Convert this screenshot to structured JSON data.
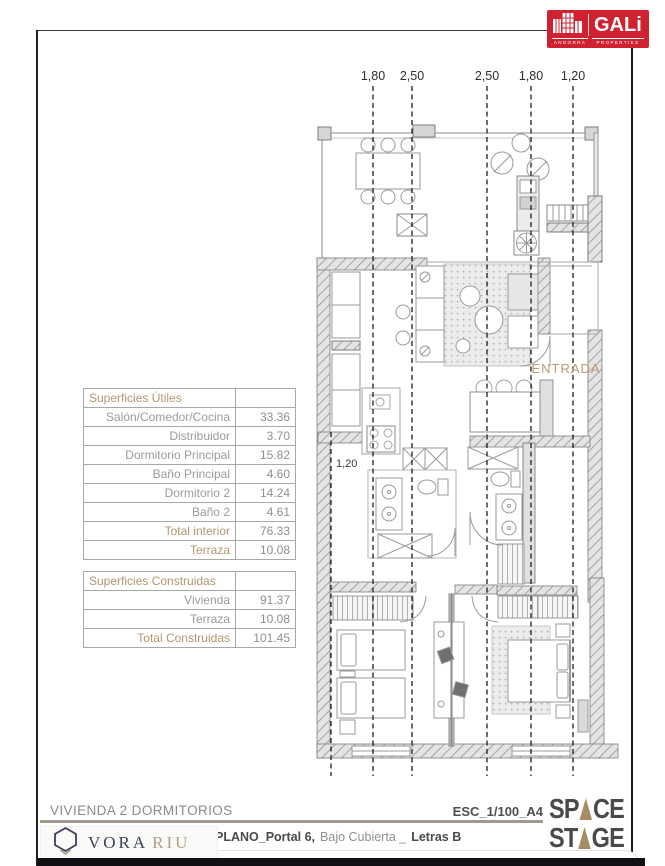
{
  "brand": {
    "gali": {
      "name": "GALi",
      "sub_left": "ANDORRA",
      "sub_right": "PROPERTIES"
    },
    "vora": {
      "word1": "VORA",
      "word2": "RIU"
    },
    "space_stage": {
      "top_left": "SP",
      "top_right": "CE",
      "bottom_left": "ST",
      "bottom_right": "GE"
    }
  },
  "tables": {
    "utiles": {
      "title": "Superficies Útiles",
      "rows": [
        {
          "label": "Salón/Comedor/Cocina",
          "value": "33.36"
        },
        {
          "label": "Distribuidor",
          "value": "3.70"
        },
        {
          "label": "Dormitorio Principal",
          "value": "15.82"
        },
        {
          "label": "Baño Principal",
          "value": "4.60"
        },
        {
          "label": "Dormitorio 2",
          "value": "14.24"
        },
        {
          "label": "Baño 2",
          "value": "4.61"
        },
        {
          "label": "Total interior",
          "value": "76.33"
        },
        {
          "label": "Terraza",
          "value": "10.08"
        }
      ]
    },
    "construidas": {
      "title": "Superficies Construidas",
      "rows": [
        {
          "label": "Vivienda",
          "value": "91.37"
        },
        {
          "label": "Terraza",
          "value": "10.08"
        },
        {
          "label": "Total Construidas",
          "value": "101.45"
        }
      ]
    }
  },
  "plan": {
    "dims_top": [
      "1,80",
      "2,50",
      "2,50",
      "1,80",
      "1,20"
    ],
    "dim_inner": "1,20",
    "entrada": "ENTRADA"
  },
  "footer": {
    "title": "VIVIENDA 2 DORMITORIOS",
    "scale": "ESC_1/100_A4",
    "plano_label": "PLANO_Portal 6,",
    "plano_mid": "Bajo Cubierta _",
    "plano_end": "Letras B"
  },
  "colors": {
    "accent_tan": "#b29670",
    "gali_red": "#cf2130",
    "navy": "#39415a",
    "stage_tan": "#a68e64"
  }
}
